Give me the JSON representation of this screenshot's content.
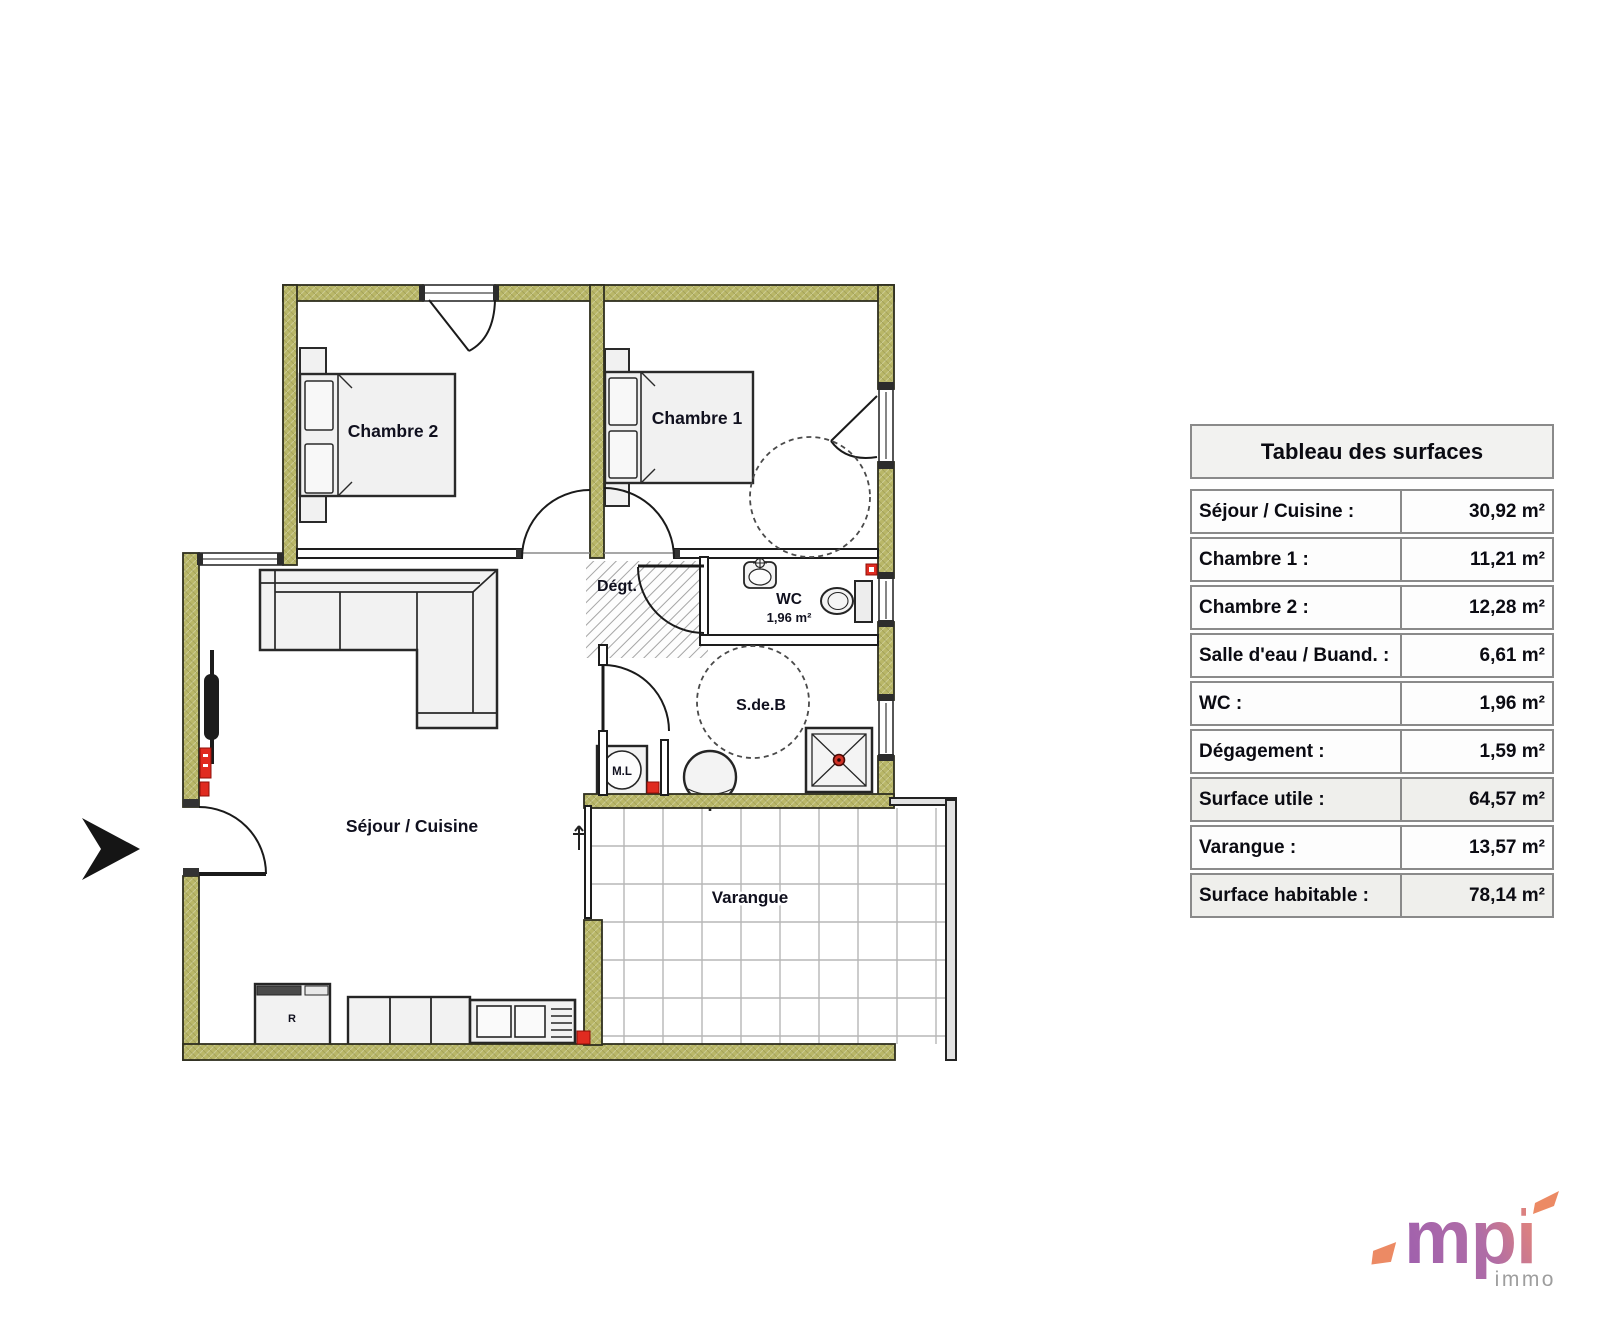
{
  "plan": {
    "rooms": {
      "chambre2": "Chambre 2",
      "chambre1": "Chambre 1",
      "degagement": "Dégt.",
      "wc": "WC",
      "wc_area": "1,96 m²",
      "salle_eau": "S.de.B",
      "lave_linge": "M.L",
      "sejour": "Séjour / Cuisine",
      "varangue": "Varangue",
      "refrigerateur": "R"
    },
    "colors": {
      "wall": "#b9b768",
      "wall_stroke": "#2f2f1f",
      "label": "#10101e",
      "marker_red": "#e02b20",
      "tile_line": "#b7b7b7"
    }
  },
  "surface_table": {
    "title": "Tableau des surfaces",
    "rows": [
      {
        "label": "Séjour / Cuisine :",
        "value": "30,92 m²",
        "highlight": false
      },
      {
        "label": "Chambre 1 :",
        "value": "11,21 m²",
        "highlight": false
      },
      {
        "label": "Chambre 2 :",
        "value": "12,28 m²",
        "highlight": false
      },
      {
        "label": "Salle d'eau / Buand. :",
        "value": "6,61 m²",
        "highlight": false
      },
      {
        "label": "WC :",
        "value": "1,96 m²",
        "highlight": false
      },
      {
        "label": "Dégagement :",
        "value": "1,59 m²",
        "highlight": false
      },
      {
        "label": "Surface utile :",
        "value": "64,57 m²",
        "highlight": true
      },
      {
        "label": "Varangue :",
        "value": "13,57 m²",
        "highlight": false
      },
      {
        "label": "Surface habitable :",
        "value": "78,14 m²",
        "highlight": true
      }
    ]
  },
  "logo": {
    "brand": "mpi",
    "sub": "immo",
    "color_from": "#9e5fae",
    "color_to": "#f0906a",
    "sub_color": "#9e9e9e"
  }
}
